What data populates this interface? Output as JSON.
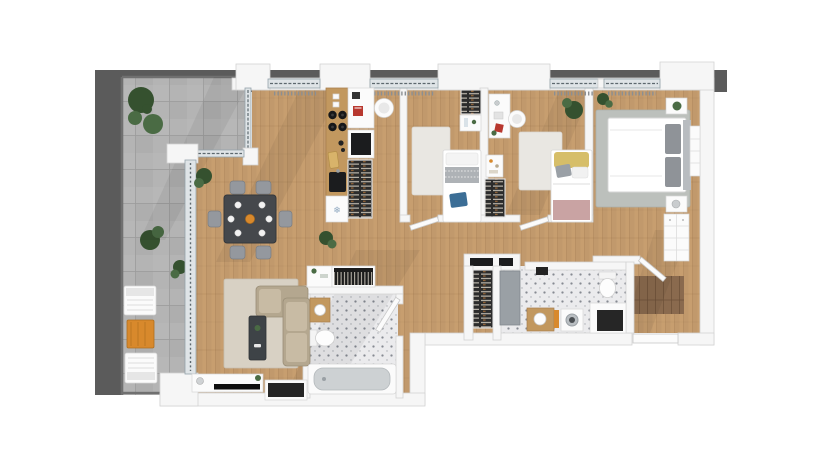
{
  "scene": {
    "label": "apartment-floor-plan",
    "view": "top-down-3d-render"
  },
  "icons": {
    "snowflake": "❄"
  },
  "colors": {
    "backdrop": "#5b5b5b",
    "terrace": "#b4b4b4",
    "terraceLine": "#9c9c9c",
    "rail": "#707070",
    "wood": "#c79e6f",
    "woodLine": "#8d6a42",
    "woodDark": "#8a6a4e",
    "wall": "#f6f6f6",
    "wallEdge": "#d3d3d3",
    "white": "#fbfbfb",
    "glass": "#dfe4e7",
    "glassLine": "#94a2aa",
    "tile": "#ebebed",
    "tileDot": "#7b8089",
    "rugBeige": "#d8d1c4",
    "rugWhite": "#e9e7e2",
    "rugGray": "#bcc0bc",
    "sofa": "#b4a78f",
    "sofaLight": "#c8bba4",
    "tableDark": "#45484c",
    "chairGray": "#94989e",
    "counter": "#c2985f",
    "appliance": "#1b1c1e",
    "slatBg": "#2c2c2c",
    "slatLine": "#d9d2c6",
    "doorGray": "#9aa0a5",
    "niche": "#262626",
    "accentBlue": "#3c6e96",
    "accentYellow": "#d6be69",
    "accentPink": "#c9a3a3",
    "accentOrange": "#d8892c",
    "accentRed": "#b8382f",
    "plant": "#4a6b44",
    "plantDark": "#35512f"
  },
  "rooms": [
    {
      "name": "terrace",
      "floor": "concrete-tiles",
      "furniture": [
        "planter-large",
        "planter-small",
        "lounge-chair",
        "side-table",
        "lounge-chair"
      ]
    },
    {
      "name": "living-dining",
      "floor": "wood-planks",
      "furniture": [
        "dining-table",
        "dining-chairs",
        "plates",
        "fruit-bowl",
        "area-rug",
        "corner-sofa",
        "coffee-table",
        "tv-console",
        "tv",
        "speaker",
        "wall-niche",
        "bookshelf",
        "sideboard",
        "plant"
      ]
    },
    {
      "name": "kitchen",
      "floor": "wood-planks",
      "furniture": [
        "counter",
        "cooktop",
        "sink",
        "cutting-board",
        "fridge-freezer",
        "upper-cabinet",
        "oven",
        "pantry-shelf",
        "desk-nook",
        "round-chair"
      ]
    },
    {
      "name": "bedroom-1",
      "floor": "wood-planks",
      "furniture": [
        "wardrobe",
        "cabinet",
        "rug",
        "single-bed",
        "blue-pillow"
      ]
    },
    {
      "name": "bedroom-2",
      "floor": "wood-planks",
      "furniture": [
        "desk",
        "round-chair",
        "cabinet",
        "wardrobe",
        "rug",
        "single-bed",
        "yellow-pillow",
        "pink-throw",
        "plant"
      ]
    },
    {
      "name": "bedroom-3",
      "floor": "wood-planks",
      "furniture": [
        "rug",
        "double-bed",
        "nightstand",
        "nightstand",
        "wardrobe",
        "dresser",
        "plant"
      ]
    },
    {
      "name": "bathroom-1",
      "floor": "mosaic-tile",
      "furniture": [
        "door",
        "toilet",
        "vanity-sink",
        "washing-machine",
        "towels",
        "storage-niche",
        "transom-windows",
        "hall-shelf"
      ]
    },
    {
      "name": "bathroom-2",
      "floor": "mosaic-tile",
      "furniture": [
        "vanity-sink",
        "toilet",
        "bathtub",
        "door"
      ]
    },
    {
      "name": "hallway-entry",
      "floor": "wood-planks",
      "furniture": [
        "entry-mat",
        "front-door"
      ]
    }
  ]
}
